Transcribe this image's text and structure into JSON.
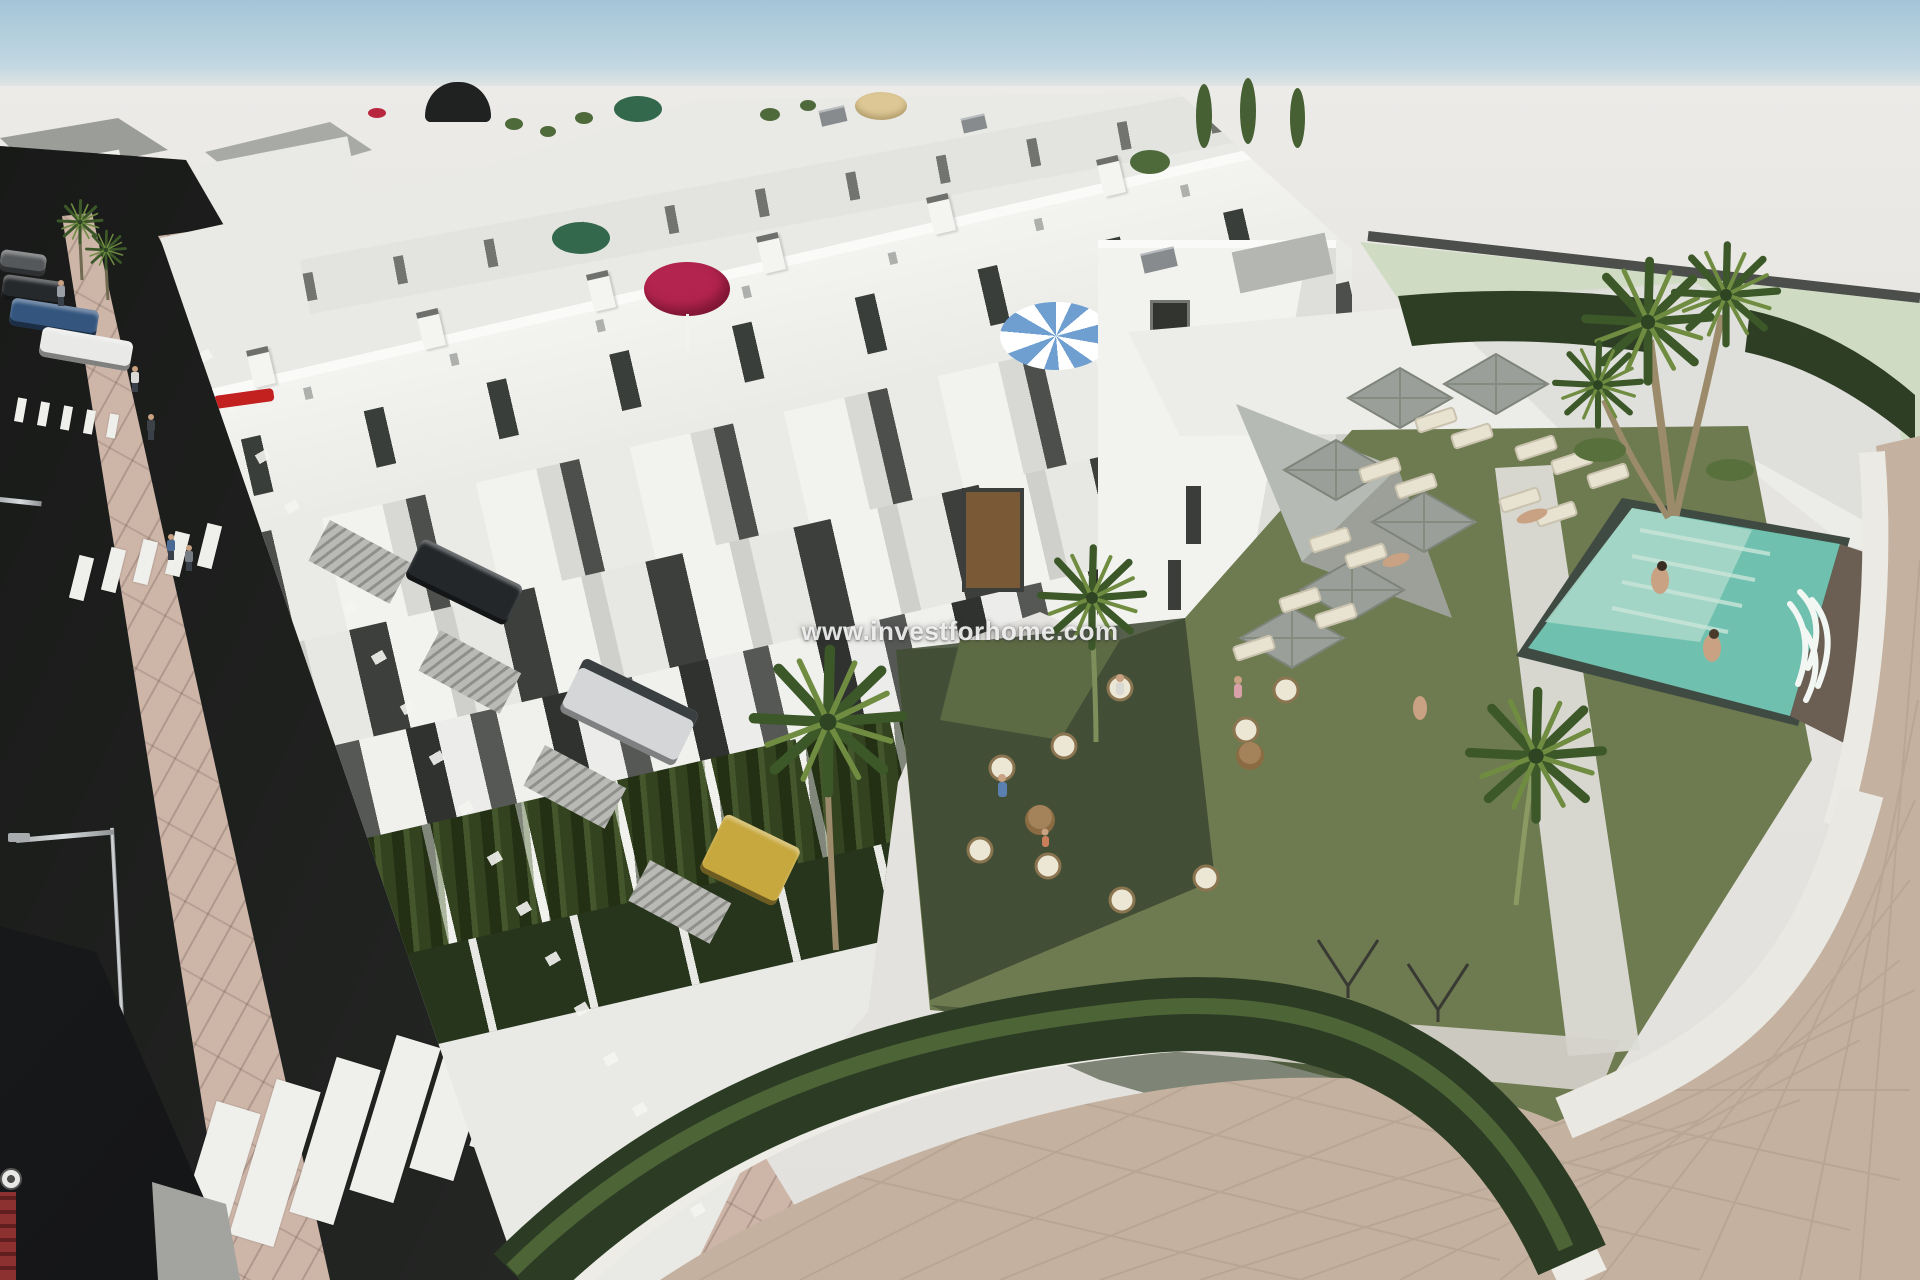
{
  "scene": {
    "type": "3d-architectural-render",
    "watermark": "www.investforhome.com"
  },
  "palette": {
    "sky": "#a3c4d8",
    "ground": "#e7e5e1",
    "mint": "#cfdcc3",
    "asphalt": "#242624",
    "sidewalk": "#cdb5a8",
    "paver": "#c4b19f",
    "curb": "#edece6",
    "building_white": "#f1f1ee",
    "facade_shadow": "#d9d9d5",
    "panel_dark": "#454745",
    "hedge": "#2e3e25",
    "hedge_light": "#54683a",
    "lawn": "#6e7b50",
    "lawn_shadow": "#3b4730",
    "pool": "#6fc0af",
    "pool_steps": "#a7d7c8",
    "umbrella_crimson": "#b3244e",
    "umbrella_green": "#34684d",
    "umbrella_tan": "#dcc795",
    "umbrella_blue": "#6f9fd0",
    "parasol_gray": "#9aa099",
    "lounger_cream": "#e8e2d0",
    "car_blue": "#33557e",
    "car_yellow": "#c7a83e",
    "accent_red": "#c32020"
  }
}
